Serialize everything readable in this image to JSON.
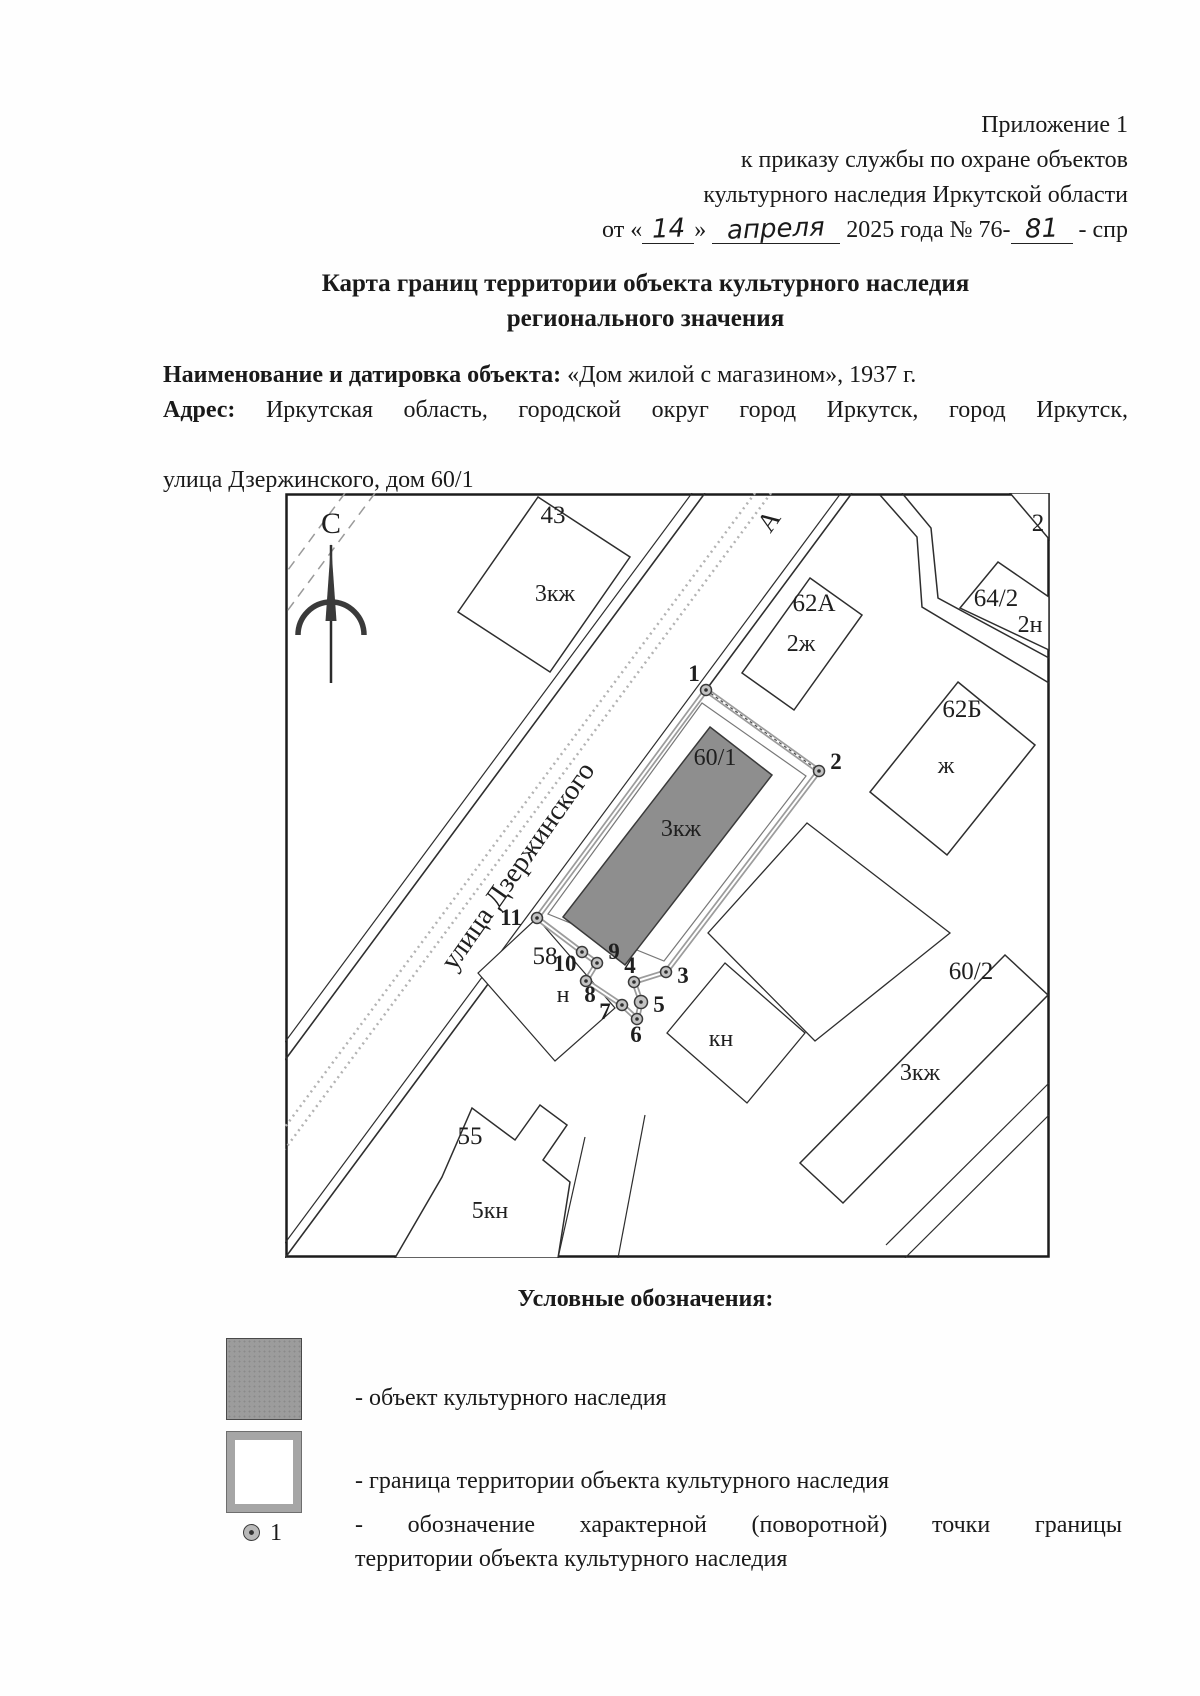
{
  "document": {
    "appendix": {
      "line1": "Приложение 1",
      "line2": "к приказу службы по охране объектов",
      "line3": "культурного наследия Иркутской области",
      "order": {
        "prefix": "от «",
        "day": "14",
        "close_quote": "»",
        "month": "апреля",
        "middle": "2025 года № 76-",
        "number": "81",
        "suffix": "- спр"
      }
    },
    "title": {
      "line1": "Карта границ территории объекта культурного наследия",
      "line2": "регионального значения"
    },
    "object": {
      "label": "Наименование и датировка объекта:",
      "value": " «Дом жилой с магазином», 1937 г."
    },
    "address": {
      "label": "Адрес:",
      "line1_rest": " Иркутская область, городской округ город Иркутск, город Иркутск,",
      "line2": "улица Дзержинского, дом 60/1"
    }
  },
  "map": {
    "north": "С",
    "street": "улица Дзержинского",
    "road": "А",
    "points": [
      "1",
      "2",
      "3",
      "4",
      "5",
      "6",
      "7",
      "8",
      "9",
      "10",
      "11"
    ],
    "parcels": {
      "p43": {
        "num": "43",
        "type": "3кж"
      },
      "p62a": {
        "num": "62А",
        "type": "2ж"
      },
      "p64_2": {
        "num": "64/2",
        "type": "2н"
      },
      "p62b": {
        "num": "62Б",
        "type": "ж"
      },
      "p60_2": {
        "num": "60/2",
        "type": "3кж"
      },
      "p55": {
        "num": "55",
        "type": "5кн"
      },
      "p58": {
        "num": "58",
        "type": "н"
      },
      "pkn": {
        "type": "кн"
      },
      "p2clip": {
        "num": "2"
      }
    },
    "object": {
      "num": "60/1",
      "type": "3кж"
    }
  },
  "legend": {
    "title": "Условные обозначения:",
    "object_text": "- объект культурного наследия",
    "boundary_text": "- граница территории объекта культурного наследия",
    "point_marker": "1",
    "point_text_line1": "- обозначение характерной (поворотной) точки границы",
    "point_text_line2": "территории объекта культурного наследия"
  },
  "colors": {
    "object_fill": "#8e8e8e",
    "boundary_line": "#9c9c9c",
    "ink": "#1a1a1a"
  }
}
